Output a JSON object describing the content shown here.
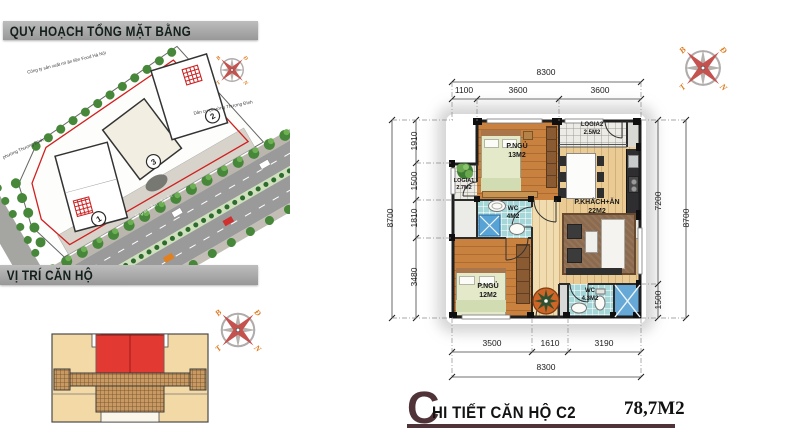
{
  "header": {
    "site_plan_title": "QUY HOẠCH TỔNG MẶT BẰNG",
    "location_title": "VỊ TRÍ CĂN HỘ"
  },
  "site_plan": {
    "labels": {
      "factory": "Công ty sản xuất mì ăn liền Food Hà Nội",
      "residential_right": "Dân cư phường Thượng Đình",
      "residential_left": "phường Thượng Đình",
      "street": "Nguyễn Trãi"
    },
    "building_numbers": [
      "1",
      "2",
      "3"
    ]
  },
  "compass": {
    "n": "B",
    "e": "Đ",
    "s": "N",
    "w": "T"
  },
  "floor_plan": {
    "rooms": {
      "bedroom1": {
        "name": "P.NGỦ",
        "area": "13M2"
      },
      "bedroom2": {
        "name": "P.NGỦ",
        "area": "12M2"
      },
      "living": {
        "name": "P.KHÁCH+ĂN",
        "area": "22M2"
      },
      "wc1": {
        "name": "WC",
        "area": "4M2"
      },
      "wc2": {
        "name": "WC",
        "area": "4.3M2"
      },
      "logia1": {
        "name": "LOGIA1",
        "area": "2.7M2"
      },
      "logia2": {
        "name": "LOGIA2",
        "area": "2.5M2"
      }
    },
    "dims": {
      "top_total": "8300",
      "top": [
        "1100",
        "3600",
        "3600"
      ],
      "left_total": "8700",
      "left": [
        "1910",
        "1500",
        "1810",
        "3480"
      ],
      "right_total": "8700",
      "right": [
        "7200",
        "1500"
      ],
      "bottom": [
        "3500",
        "1610",
        "3190"
      ],
      "bottom_total": "8300"
    }
  },
  "footer": {
    "title_initial": "C",
    "title_rest": "HI TIẾT CĂN HỘ C2",
    "area": "78,7M2"
  },
  "colors": {
    "highlight_red": "#e23a32",
    "wood": "#c9813f",
    "tile_blue": "#a5d6d8",
    "maroon": "#4f3339"
  }
}
